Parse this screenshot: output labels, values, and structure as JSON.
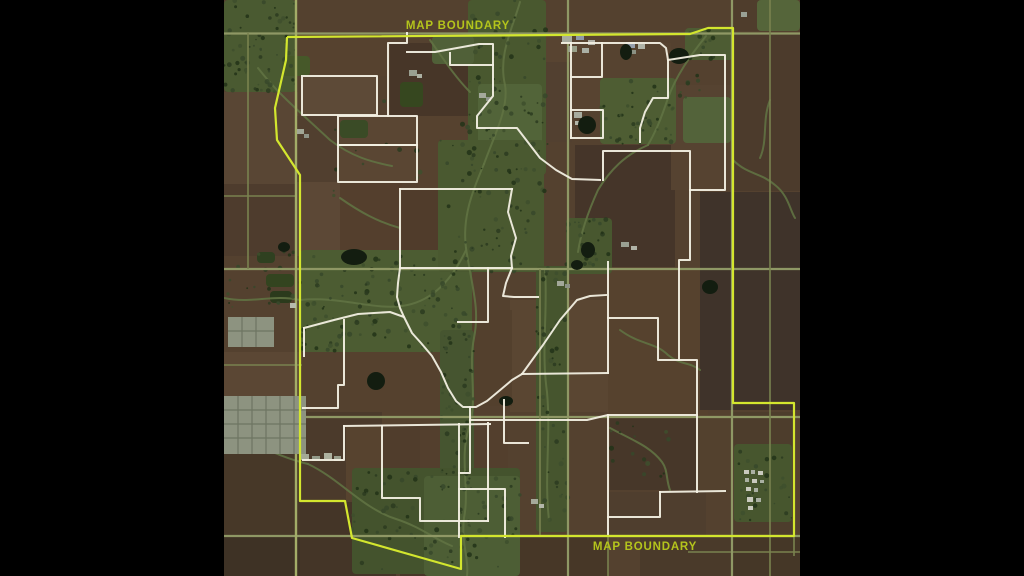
{
  "scene": {
    "width": 1024,
    "height": 576,
    "background": "#000000"
  },
  "map": {
    "x": 224,
    "y": 0,
    "size": 576,
    "base_color": "#54412f"
  },
  "labels": {
    "top": {
      "text": "MAP BOUNDARY",
      "x": 458,
      "y": 29
    },
    "bottom": {
      "text": "MAP BOUNDARY",
      "x": 645,
      "y": 550
    }
  },
  "colors": {
    "boundary": "#d3e62e",
    "label": "#b4c41c",
    "parcel": "#f2efe2",
    "road_major": "#8f9865",
    "road_minor": "#79824f",
    "road_left": "#a3ad68",
    "creek": "#617243",
    "pond": "#131d10",
    "town": "#8d9380",
    "town_line": "#6e7562"
  },
  "boundary_outline": {
    "width": 2.2,
    "points": [
      [
        287,
        37
      ],
      [
        690,
        34
      ],
      [
        708,
        28
      ],
      [
        733,
        28
      ],
      [
        733,
        403
      ],
      [
        794,
        403
      ],
      [
        794,
        536
      ],
      [
        461,
        536
      ],
      [
        461,
        569
      ],
      [
        352,
        538
      ],
      [
        345,
        501
      ],
      [
        300,
        501
      ],
      [
        300,
        175
      ],
      [
        277,
        140
      ],
      [
        275,
        108
      ],
      [
        286,
        60
      ],
      [
        287,
        37
      ]
    ]
  },
  "parcel_outlines": [
    [
      [
        302,
        76
      ],
      [
        377,
        76
      ],
      [
        377,
        115
      ],
      [
        302,
        115
      ],
      [
        302,
        76
      ]
    ],
    [
      [
        338,
        116
      ],
      [
        417,
        116
      ],
      [
        417,
        145
      ],
      [
        338,
        145
      ],
      [
        338,
        116
      ]
    ],
    [
      [
        338,
        145
      ],
      [
        417,
        145
      ],
      [
        417,
        182
      ],
      [
        338,
        182
      ],
      [
        338,
        145
      ]
    ],
    [
      [
        388,
        116
      ],
      [
        388,
        43
      ],
      [
        407,
        43
      ],
      [
        407,
        33
      ]
    ],
    [
      [
        407,
        52
      ],
      [
        435,
        52
      ],
      [
        479,
        44
      ],
      [
        493,
        44
      ],
      [
        493,
        65
      ],
      [
        450,
        65
      ],
      [
        450,
        53
      ]
    ],
    [
      [
        493,
        65
      ],
      [
        493,
        96
      ],
      [
        477,
        116
      ],
      [
        477,
        128
      ],
      [
        517,
        128
      ],
      [
        540,
        158
      ],
      [
        556,
        170
      ],
      [
        572,
        179
      ],
      [
        600,
        180
      ]
    ],
    [
      [
        571,
        43
      ],
      [
        571,
        138
      ]
    ],
    [
      [
        562,
        43
      ],
      [
        602,
        43
      ],
      [
        602,
        77
      ],
      [
        571,
        77
      ]
    ],
    [
      [
        571,
        110
      ],
      [
        603,
        110
      ],
      [
        603,
        138
      ],
      [
        571,
        138
      ]
    ],
    [
      [
        602,
        43
      ],
      [
        660,
        43
      ],
      [
        666,
        48
      ],
      [
        668,
        60
      ],
      [
        668,
        98
      ],
      [
        653,
        98
      ],
      [
        645,
        112
      ],
      [
        640,
        128
      ],
      [
        640,
        142
      ]
    ],
    [
      [
        668,
        60
      ],
      [
        700,
        55
      ],
      [
        725,
        55
      ],
      [
        725,
        190
      ],
      [
        690,
        190
      ]
    ],
    [
      [
        603,
        180
      ],
      [
        603,
        151
      ],
      [
        690,
        151
      ],
      [
        690,
        260
      ],
      [
        679,
        260
      ],
      [
        679,
        360
      ]
    ],
    [
      [
        608,
        262
      ],
      [
        608,
        373
      ]
    ],
    [
      [
        608,
        415
      ],
      [
        608,
        536
      ]
    ],
    [
      [
        608,
        318
      ],
      [
        658,
        318
      ],
      [
        658,
        360
      ],
      [
        697,
        360
      ],
      [
        697,
        492
      ]
    ],
    [
      [
        470,
        420
      ],
      [
        587,
        420
      ],
      [
        608,
        415
      ],
      [
        697,
        415
      ]
    ],
    [
      [
        660,
        492
      ],
      [
        725,
        491
      ]
    ],
    [
      [
        660,
        492
      ],
      [
        660,
        517
      ],
      [
        608,
        517
      ]
    ],
    [
      [
        400,
        189
      ],
      [
        512,
        189
      ]
    ],
    [
      [
        512,
        189
      ],
      [
        508,
        212
      ],
      [
        516,
        238
      ],
      [
        511,
        256
      ],
      [
        512,
        268
      ]
    ],
    [
      [
        400,
        189
      ],
      [
        400,
        268
      ],
      [
        398,
        283
      ],
      [
        397,
        297
      ],
      [
        400,
        308
      ],
      [
        404,
        317
      ]
    ],
    [
      [
        400,
        268
      ],
      [
        512,
        268
      ]
    ],
    [
      [
        512,
        268
      ],
      [
        506,
        283
      ],
      [
        503,
        296
      ],
      [
        514,
        297
      ],
      [
        538,
        297
      ]
    ],
    [
      [
        304,
        328
      ],
      [
        334,
        320
      ],
      [
        358,
        314
      ],
      [
        390,
        312
      ],
      [
        404,
        317
      ],
      [
        412,
        333
      ],
      [
        421,
        343
      ],
      [
        432,
        356
      ],
      [
        441,
        372
      ],
      [
        448,
        388
      ],
      [
        456,
        401
      ],
      [
        463,
        407
      ],
      [
        470,
        407
      ],
      [
        470,
        420
      ]
    ],
    [
      [
        470,
        407
      ],
      [
        476,
        407
      ],
      [
        487,
        401
      ],
      [
        499,
        391
      ],
      [
        512,
        380
      ],
      [
        522,
        374
      ],
      [
        543,
        345
      ],
      [
        560,
        320
      ],
      [
        577,
        300
      ],
      [
        590,
        296
      ],
      [
        606,
        295
      ]
    ],
    [
      [
        344,
        320
      ],
      [
        344,
        385
      ],
      [
        338,
        385
      ],
      [
        338,
        408
      ],
      [
        303,
        408
      ]
    ],
    [
      [
        304,
        328
      ],
      [
        304,
        356
      ]
    ],
    [
      [
        344,
        426
      ],
      [
        344,
        460
      ],
      [
        303,
        460
      ]
    ],
    [
      [
        344,
        426
      ],
      [
        490,
        424
      ]
    ],
    [
      [
        382,
        426
      ],
      [
        382,
        498
      ],
      [
        420,
        498
      ],
      [
        420,
        521
      ],
      [
        488,
        521
      ]
    ],
    [
      [
        459,
        424
      ],
      [
        459,
        537
      ]
    ],
    [
      [
        459,
        489
      ],
      [
        505,
        489
      ],
      [
        505,
        537
      ]
    ],
    [
      [
        488,
        423
      ],
      [
        488,
        521
      ]
    ],
    [
      [
        488,
        268
      ],
      [
        488,
        322
      ],
      [
        458,
        322
      ]
    ],
    [
      [
        504,
        400
      ],
      [
        504,
        443
      ],
      [
        528,
        443
      ]
    ],
    [
      [
        470,
        420
      ],
      [
        470,
        473
      ],
      [
        459,
        473
      ]
    ],
    [
      [
        522,
        374
      ],
      [
        608,
        373
      ]
    ]
  ],
  "fields": [
    [
      224,
      92,
      74,
      92,
      "#594634"
    ],
    [
      224,
      184,
      74,
      72,
      "#4e3c2d"
    ],
    [
      224,
      352,
      78,
      46,
      "#5b4734"
    ],
    [
      224,
      450,
      80,
      86,
      "#473828"
    ],
    [
      224,
      536,
      80,
      40,
      "#3e3225"
    ],
    [
      298,
      33,
      92,
      43,
      "#56422f"
    ],
    [
      302,
      76,
      75,
      39,
      "#5d4a37"
    ],
    [
      296,
      116,
      42,
      66,
      "#513f2f"
    ],
    [
      338,
      116,
      79,
      66,
      "#5a4633"
    ],
    [
      390,
      43,
      100,
      73,
      "#473628"
    ],
    [
      418,
      116,
      74,
      74,
      "#56422f"
    ],
    [
      340,
      182,
      62,
      88,
      "#543f2d"
    ],
    [
      296,
      182,
      44,
      74,
      "#5c4836"
    ],
    [
      402,
      190,
      108,
      78,
      "#503c2b"
    ],
    [
      510,
      300,
      98,
      112,
      "#5a4632"
    ],
    [
      460,
      310,
      52,
      96,
      "#53402d"
    ],
    [
      350,
      352,
      110,
      74,
      "#55412e"
    ],
    [
      300,
      412,
      82,
      88,
      "#4b3a2b"
    ],
    [
      300,
      502,
      96,
      74,
      "#443527"
    ],
    [
      346,
      426,
      36,
      74,
      "#57432f"
    ],
    [
      382,
      426,
      76,
      72,
      "#503d2c"
    ],
    [
      420,
      430,
      88,
      58,
      "#533f2d"
    ],
    [
      400,
      537,
      208,
      39,
      "#473727"
    ],
    [
      545,
      33,
      75,
      78,
      "#584431"
    ],
    [
      575,
      145,
      100,
      122,
      "#453529"
    ],
    [
      520,
      62,
      52,
      80,
      "#524030"
    ],
    [
      608,
      270,
      100,
      145,
      "#56422e"
    ],
    [
      610,
      417,
      86,
      73,
      "#473729"
    ],
    [
      697,
      417,
      36,
      75,
      "#53412e"
    ],
    [
      608,
      492,
      98,
      44,
      "#4f3e2e"
    ],
    [
      605,
      43,
      66,
      58,
      "#564330"
    ],
    [
      671,
      85,
      62,
      105,
      "#564331"
    ],
    [
      733,
      33,
      67,
      158,
      "#4c3b2c"
    ],
    [
      700,
      192,
      100,
      218,
      "#3f332a"
    ],
    [
      733,
      412,
      61,
      124,
      "#4d3d2c"
    ],
    [
      733,
      536,
      67,
      40,
      "#453727"
    ],
    [
      640,
      536,
      92,
      40,
      "#4a3a2a"
    ],
    [
      733,
      0,
      26,
      31,
      "#4f3d2c"
    ]
  ],
  "greens": [
    [
      224,
      0,
      72,
      92,
      "#4a5a31"
    ],
    [
      468,
      0,
      78,
      175,
      "#49582f"
    ],
    [
      478,
      84,
      64,
      66,
      "#526439"
    ],
    [
      300,
      250,
      172,
      102,
      "#4c5c32"
    ],
    [
      438,
      140,
      106,
      132,
      "#4a5930"
    ],
    [
      440,
      330,
      34,
      164,
      "#465530"
    ],
    [
      352,
      468,
      168,
      106,
      "#44532d"
    ],
    [
      424,
      476,
      96,
      100,
      "#4d5e35"
    ],
    [
      536,
      266,
      32,
      266,
      "#46552e"
    ],
    [
      600,
      78,
      76,
      66,
      "#4e5d33"
    ],
    [
      566,
      218,
      46,
      56,
      "#48572f"
    ],
    [
      734,
      444,
      58,
      78,
      "#47562e"
    ],
    [
      685,
      28,
      48,
      32,
      "#4d5c33"
    ],
    [
      757,
      0,
      43,
      31,
      "#55653a"
    ],
    [
      683,
      97,
      48,
      46,
      "#53633a"
    ],
    [
      432,
      36,
      42,
      28,
      "#506038"
    ],
    [
      266,
      274,
      28,
      13,
      "#33441f"
    ],
    [
      270,
      291,
      22,
      12,
      "#2b3a1c"
    ],
    [
      257,
      252,
      18,
      11,
      "#2f4020"
    ],
    [
      282,
      56,
      28,
      20,
      "#465829"
    ],
    [
      400,
      82,
      23,
      25,
      "#36471f"
    ],
    [
      340,
      120,
      28,
      18,
      "#3a4b26"
    ]
  ],
  "creeks": [
    "M520,2 C512,30 498,55 505,85 C509,108 494,136 484,164",
    "M484,164 C472,192 462,218 466,248",
    "M466,248 C472,288 480,308 474,338 C468,368 478,398 469,428",
    "M469,428 C459,458 470,488 464,518 C461,543 469,558 467,576",
    "M224,298 C252,304 272,294 300,300 C340,296 372,310 402,306",
    "M402,306 C432,302 452,280 466,250",
    "M308,464 C340,479 362,508 396,519 C421,527 436,540 452,546",
    "M224,432 C252,441 275,456 308,464",
    "M706,36 C690,56 676,76 668,98 C661,119 656,131 648,145",
    "M648,145 C625,155 610,170 598,190 C588,212 581,232 578,252",
    "M545,270 C548,310 541,350 547,392 C551,436 544,478 549,520",
    "M610,428 C632,440 650,446 662,462 C668,470 666,480 670,490",
    "M258,68 C278,94 300,112 330,140 C352,157 372,162 392,166",
    "M430,40 C444,60 456,78 470,92",
    "M733,160 C748,175 760,172 775,185 C788,195 790,210 795,218",
    "M620,330 C640,345 655,342 668,355 C680,365 690,362 700,370",
    "M340,198 C360,212 378,222 400,228",
    "M770,100 C762,120 768,140 760,158"
  ],
  "roads": {
    "horizontal_major": [
      [
        224,
        33.5,
        800
      ],
      [
        224,
        269,
        800
      ],
      [
        224,
        417,
        800
      ],
      [
        224,
        536,
        800
      ]
    ],
    "horizontal_minor": [
      [
        224,
        365,
        302
      ],
      [
        688,
        552,
        800
      ],
      [
        224,
        196,
        296
      ]
    ],
    "vertical_major": [
      [
        568,
        0,
        576
      ],
      [
        732,
        0,
        576
      ]
    ],
    "vertical_minor": [
      [
        770,
        0,
        576
      ],
      [
        248,
        33,
        269
      ],
      [
        608,
        536,
        576
      ],
      [
        540,
        269,
        536
      ],
      [
        794,
        403,
        556
      ]
    ],
    "vertical_left": [
      [
        296,
        0,
        576
      ]
    ]
  },
  "town_blocks": [
    {
      "rect": [
        224,
        396,
        82,
        58
      ],
      "vlines": [
        238,
        252,
        266,
        280,
        294
      ],
      "hlines": [
        410,
        424,
        438
      ]
    },
    {
      "rect": [
        228,
        317,
        46,
        30
      ],
      "vlines": [
        242,
        256
      ],
      "hlines": [
        331
      ]
    }
  ],
  "buildings": [
    [
      562,
      36,
      10,
      7,
      "#a8aca0"
    ],
    [
      576,
      34,
      8,
      6,
      "#8e99a8"
    ],
    [
      588,
      40,
      7,
      5,
      "#b5b5ab"
    ],
    [
      568,
      46,
      9,
      6,
      "#99a089"
    ],
    [
      582,
      48,
      7,
      5,
      "#aab0a5"
    ],
    [
      626,
      42,
      9,
      6,
      "#97a0ad"
    ],
    [
      638,
      44,
      7,
      5,
      "#b0b4a8"
    ],
    [
      630,
      50,
      6,
      4,
      "#8b9183"
    ],
    [
      574,
      112,
      8,
      6,
      "#a9ada0"
    ],
    [
      584,
      118,
      7,
      5,
      "#969c8e"
    ],
    [
      575,
      121,
      6,
      4,
      "#b3b7aa"
    ],
    [
      479,
      93,
      7,
      5,
      "#a5a99c"
    ],
    [
      486,
      97,
      5,
      4,
      "#8f958a"
    ],
    [
      744,
      470,
      5,
      4,
      "#c9cabe"
    ],
    [
      751,
      470,
      4,
      4,
      "#aab0a2"
    ],
    [
      758,
      471,
      5,
      4,
      "#c9cabe"
    ],
    [
      745,
      478,
      4,
      4,
      "#aab0a2"
    ],
    [
      752,
      479,
      5,
      4,
      "#c9cabe"
    ],
    [
      760,
      480,
      4,
      3,
      "#aab0a2"
    ],
    [
      746,
      487,
      5,
      4,
      "#c9cabe"
    ],
    [
      754,
      488,
      4,
      4,
      "#aab0a2"
    ],
    [
      747,
      497,
      6,
      5,
      "#c9cabe"
    ],
    [
      756,
      498,
      5,
      4,
      "#aab0a2"
    ],
    [
      748,
      506,
      5,
      4,
      "#c9cabe"
    ],
    [
      621,
      242,
      8,
      5,
      "#9aa092"
    ],
    [
      631,
      246,
      6,
      4,
      "#b0b3a6"
    ],
    [
      557,
      281,
      7,
      5,
      "#a3a89a"
    ],
    [
      565,
      284,
      5,
      4,
      "#8d9286"
    ],
    [
      531,
      499,
      7,
      5,
      "#a5a99a"
    ],
    [
      539,
      504,
      5,
      4,
      "#b4b7ab"
    ],
    [
      409,
      70,
      8,
      6,
      "#9aa091"
    ],
    [
      417,
      74,
      5,
      4,
      "#adb1a3"
    ],
    [
      297,
      129,
      7,
      5,
      "#a2a796"
    ],
    [
      304,
      134,
      5,
      4,
      "#8f9487"
    ],
    [
      741,
      12,
      6,
      5,
      "#9aa195"
    ],
    [
      290,
      303,
      6,
      5,
      "#b7bbac"
    ],
    [
      300,
      454,
      9,
      6,
      "#a4a995"
    ],
    [
      312,
      456,
      8,
      5,
      "#939a89"
    ],
    [
      324,
      453,
      8,
      6,
      "#adb19f"
    ],
    [
      334,
      456,
      7,
      5,
      "#9aa08e"
    ]
  ],
  "ponds": [
    [
      354,
      257,
      13,
      8
    ],
    [
      376,
      381,
      9,
      9
    ],
    [
      506,
      401,
      7,
      5
    ],
    [
      588,
      250,
      7,
      8
    ],
    [
      577,
      265,
      6,
      5
    ],
    [
      679,
      56,
      10,
      8
    ],
    [
      710,
      287,
      8,
      7
    ],
    [
      587,
      125,
      9,
      9
    ],
    [
      284,
      247,
      6,
      5
    ],
    [
      626,
      52,
      6,
      8
    ]
  ],
  "tree_zones": [
    [
      224,
      0,
      72,
      92,
      60
    ],
    [
      460,
      0,
      88,
      180,
      70
    ],
    [
      300,
      256,
      170,
      96,
      110
    ],
    [
      440,
      140,
      105,
      135,
      65
    ],
    [
      440,
      330,
      36,
      160,
      45
    ],
    [
      352,
      470,
      168,
      100,
      80
    ],
    [
      536,
      268,
      32,
      264,
      45
    ],
    [
      600,
      80,
      74,
      64,
      40
    ],
    [
      566,
      218,
      44,
      52,
      28
    ],
    [
      680,
      30,
      40,
      70,
      22
    ],
    [
      736,
      444,
      56,
      76,
      25
    ],
    [
      610,
      420,
      60,
      60,
      15
    ],
    [
      310,
      90,
      120,
      110,
      12
    ],
    [
      224,
      250,
      76,
      60,
      18
    ]
  ],
  "tree_colors": [
    "#2c3b20",
    "#37482a",
    "#223218",
    "#3e4f2d"
  ]
}
